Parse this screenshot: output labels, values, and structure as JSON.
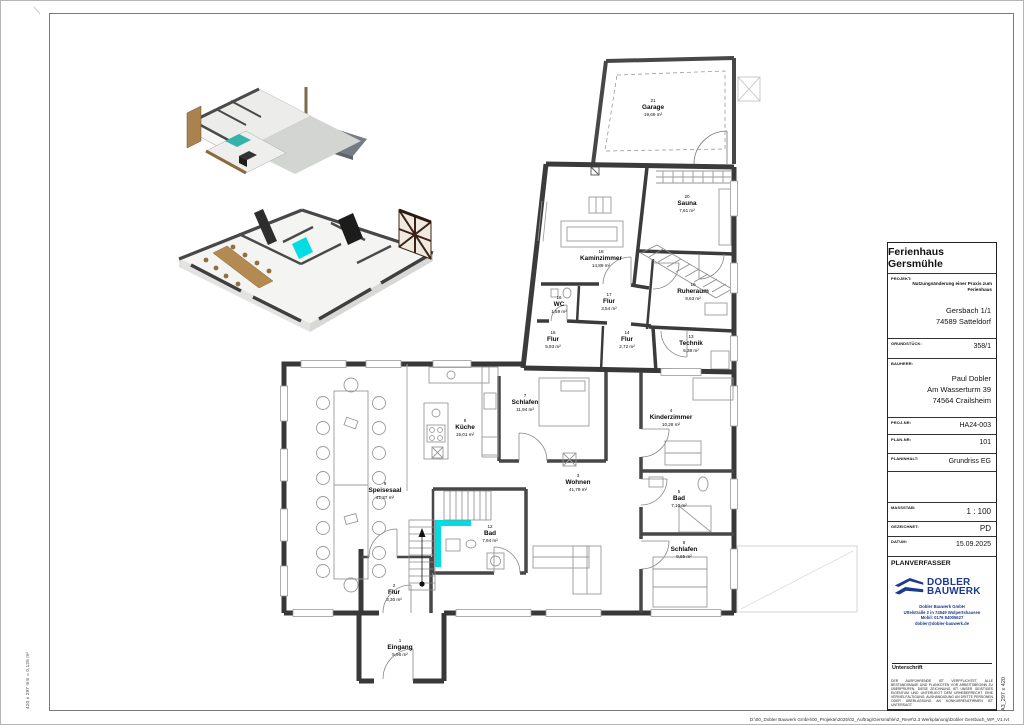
{
  "page": {
    "sheet_note_left": "420 x 297 mm = 0,125 m²",
    "sheet_note_right": "A3_297 x 420",
    "file_path": "D:\\00_Dobler Bauwerk GmbH\\00_Projekte\\2025\\02_Auftrag\\Gersmühle\\2_Rev#\\2.3 Werkplanung\\Dobler Gersbach_WP_V1.rvt"
  },
  "titleblock": {
    "title": "Ferienhaus Gersmühle",
    "projekt_label": "PROJEKT:",
    "projekt_value": "Nutzungsänderung einer Praxis zum Ferienhaus",
    "address1": "Gersbach 1/1",
    "address2": "74589 Satteldorf",
    "grundstueck_label": "GRUNDSTÜCK:",
    "grundstueck_value": "358/1",
    "bauherr_label": "BAUHERR:",
    "bauherr_name": "Paul Dobler",
    "bauherr_street": "Am Wasserturm 39",
    "bauherr_city": "74564 Crailsheim",
    "projnr_label": "PROJ-NR:",
    "projnr_value": "HA24-003",
    "plannr_label": "PLAN-NR:",
    "plannr_value": "101",
    "planinhalt_label": "PLANINHALT:",
    "planinhalt_value": "Grundriss EG",
    "massstab_label": "MASSSTAB:",
    "massstab_value": "1 : 100",
    "gezeichnet_label": "GEZEICHNET:",
    "gezeichnet_value": "PD",
    "datum_label": "DATUM:",
    "datum_value": "15.09.2025",
    "planverfasser_label": "PLANVERFASSER",
    "firm": {
      "logo_line1": "DOBLER",
      "logo_line2": "BAUWERK",
      "logo_color": "#1d3a8f",
      "name": "Dobler Bauwerk GmbH",
      "street": "Uttelstraße 2 in 74549 Wolpertshausen",
      "mobile": "Mobil: 0176 84005627",
      "email": "dobler@dobler-bauwerk.de"
    },
    "unterschrift_label": "Unterschrift",
    "disclaimer": "DER AUSFÜHRENDE IST VERPFLICHTET, ALLE BESTANDSMAßE UND PLANKOTEN VOR ARBEITSBEGINN ZU ÜBERPRÜFEN. DIESE ZEICHNUNG IST UNSER GEISTIGES EIGENTUM UND UNTERLIEGT DEM URHEBERRECHT. EINE VERVIELFÄLTIGUNG, AUSHÄNDIGUNG AN DRITTE PERSONEN ODER ÜBERLASSUNG AN KONKURRENZFIRMEN IST UNTERSAGT."
  },
  "plan": {
    "accent_color": "#00dee4",
    "rooms": [
      {
        "num": "21",
        "name": "Garage",
        "area": "19,69 m²"
      },
      {
        "num": "20",
        "name": "Sauna",
        "area": "7,61 m²"
      },
      {
        "num": "18",
        "name": "Kaminzimmer",
        "area": "14,89 m²"
      },
      {
        "num": "19",
        "name": "Ruheraum",
        "area": "9,63 m²"
      },
      {
        "num": "16",
        "name": "WC",
        "area": "1,59 m²"
      },
      {
        "num": "17",
        "name": "Flur",
        "area": "3,54 m²"
      },
      {
        "num": "15",
        "name": "Flur",
        "area": "5,93 m²"
      },
      {
        "num": "14",
        "name": "Flur",
        "area": "2,72 m²"
      },
      {
        "num": "13",
        "name": "Technik",
        "area": "5,38 m²"
      },
      {
        "num": "7",
        "name": "Schlafen",
        "area": "11,94 m²"
      },
      {
        "num": "8",
        "name": "Küche",
        "area": "15,01 m²"
      },
      {
        "num": "4",
        "name": "Kinderzimmer",
        "area": "10,28 m²"
      },
      {
        "num": "3",
        "name": "Wohnen",
        "area": "41,79 m²"
      },
      {
        "num": "9",
        "name": "Speisesaal",
        "area": "41,37 m²"
      },
      {
        "num": "5",
        "name": "Bad",
        "area": "7,10 m²"
      },
      {
        "num": "6",
        "name": "Schlafen",
        "area": "9,65 m²"
      },
      {
        "num": "12",
        "name": "Bad",
        "area": "7,94 m²"
      },
      {
        "num": "2",
        "name": "Flur",
        "area": "3,30 m²"
      },
      {
        "num": "1",
        "name": "Eingang",
        "area": "5,96 m²"
      }
    ]
  }
}
